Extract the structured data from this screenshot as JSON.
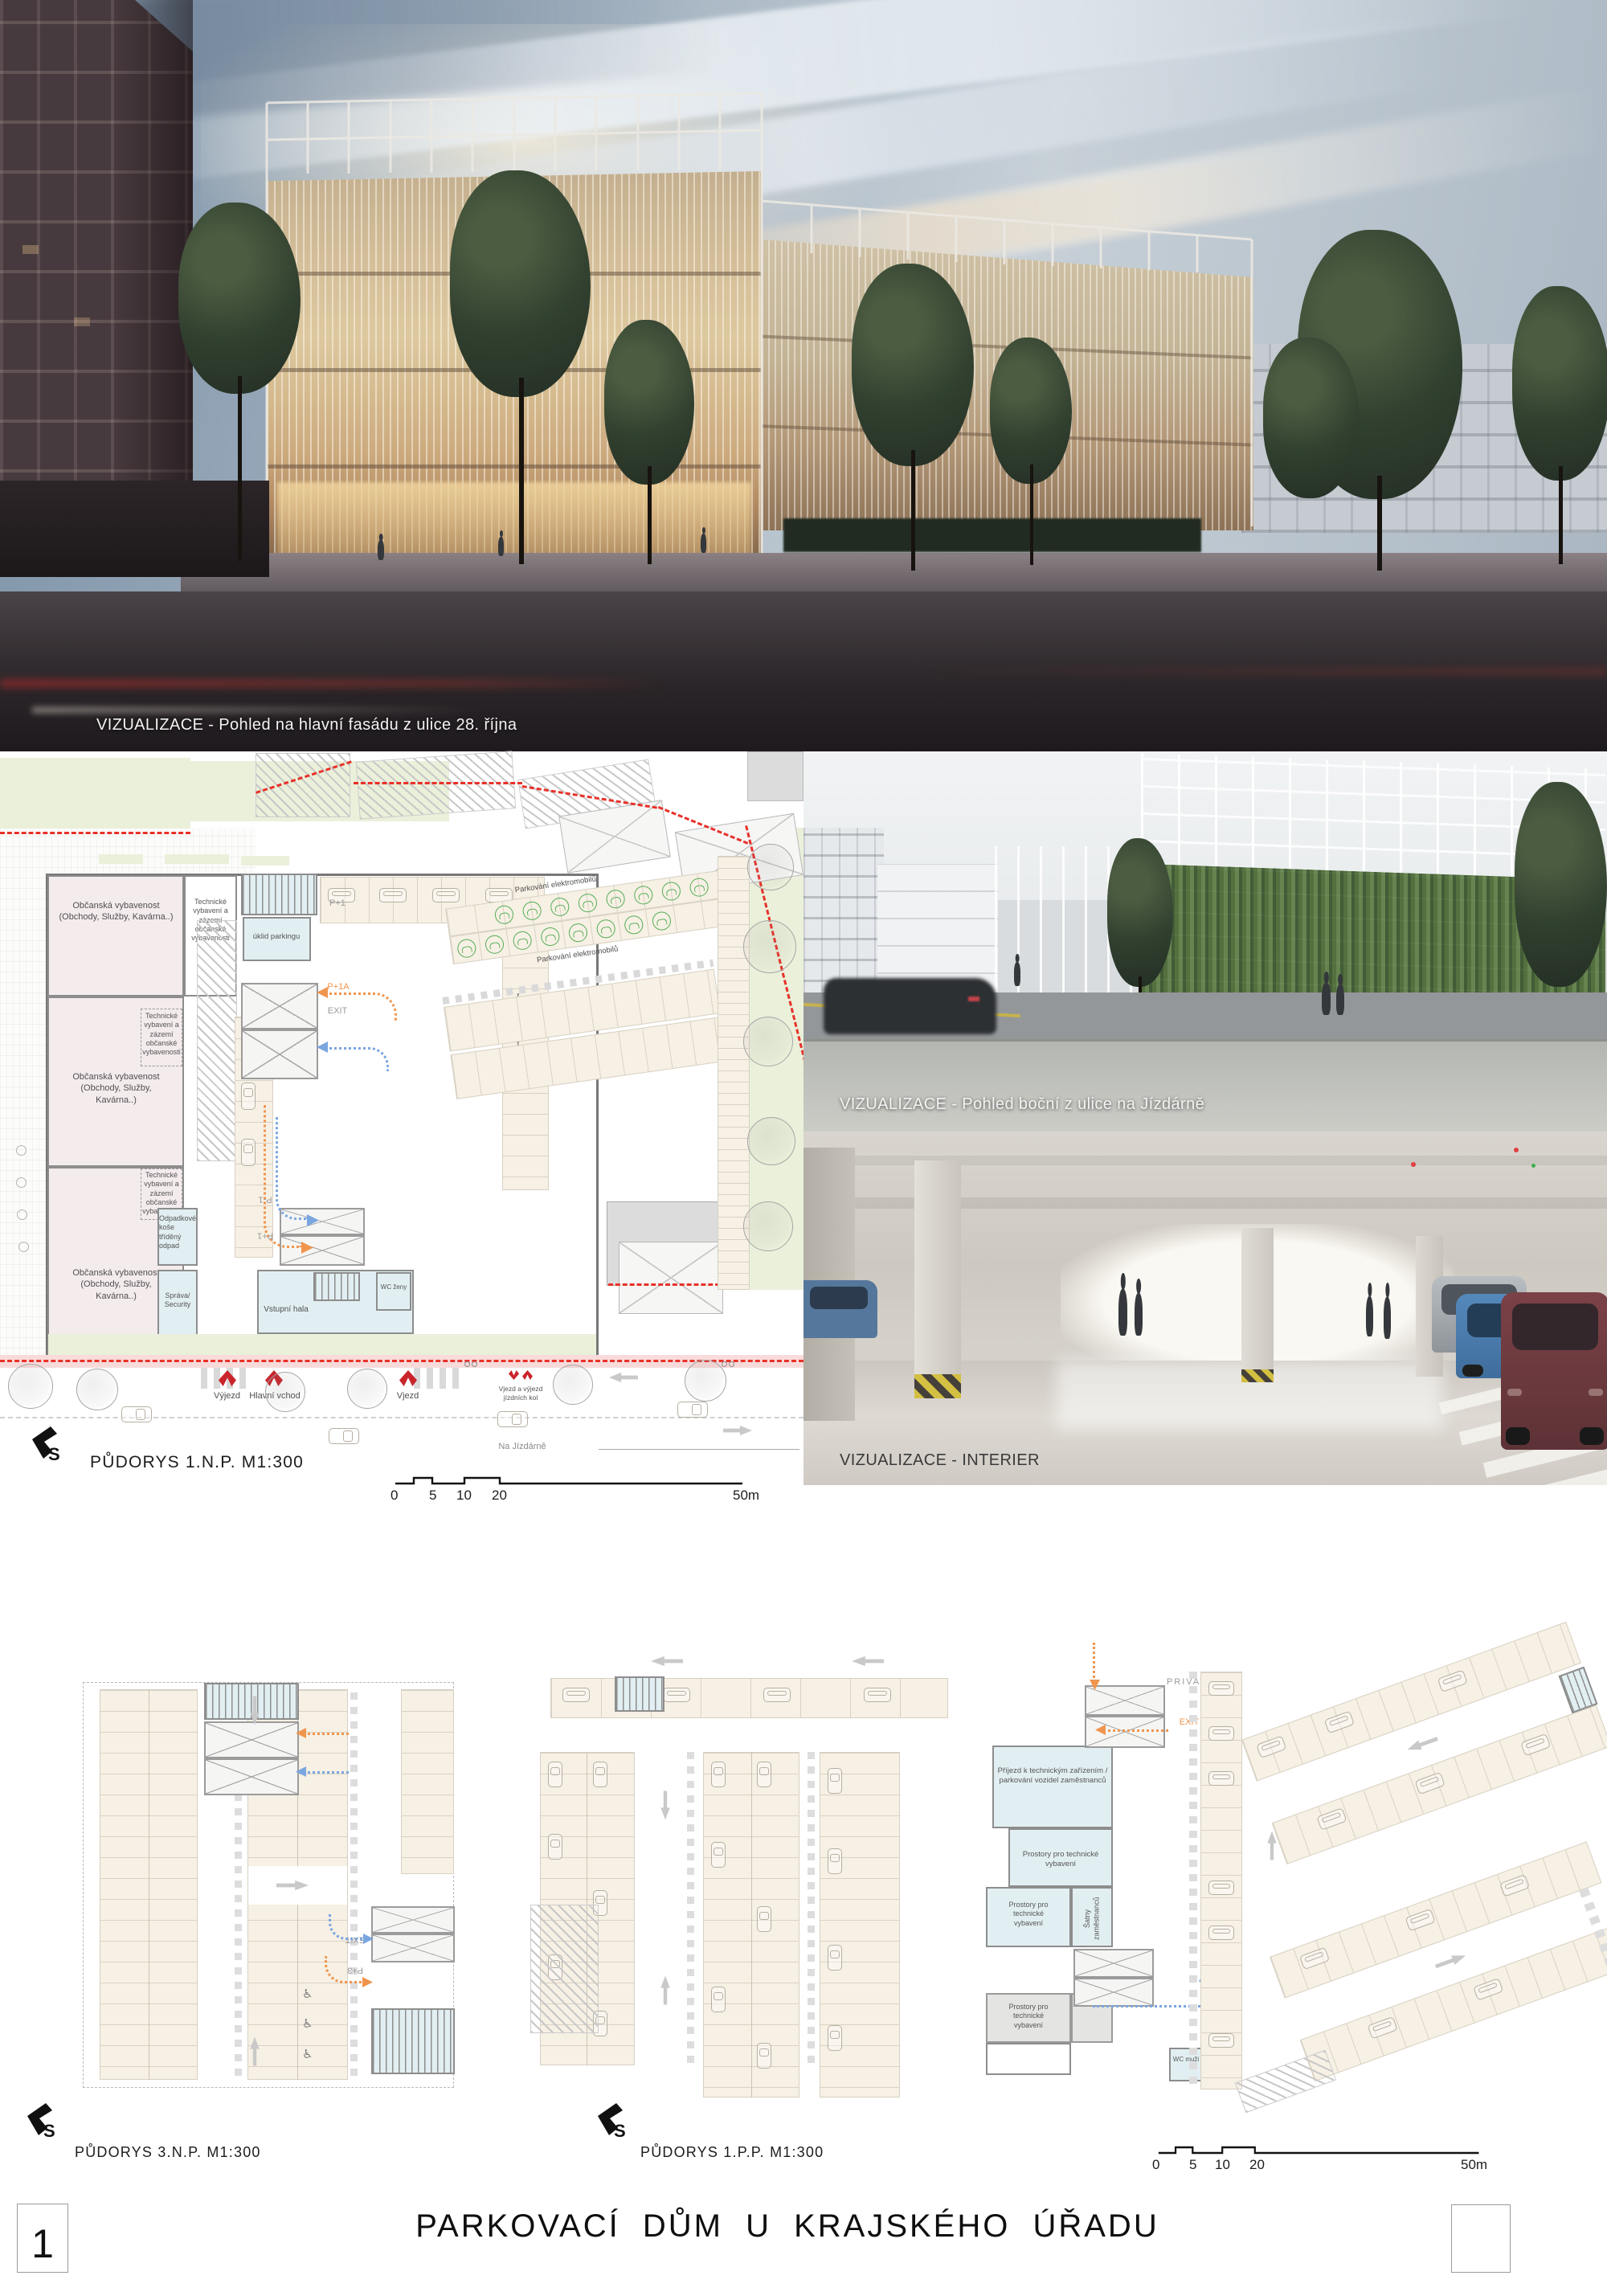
{
  "board": {
    "title": "PARKOVACÍ  DŮM  U  KRAJSKÉHO  ÚŘADU",
    "sheet_number": "1"
  },
  "visualizations": {
    "main": {
      "caption": "VIZUALIZACE - Pohled na hlavní fasádu z ulice 28. října"
    },
    "side": {
      "caption": "VIZUALIZACE - Pohled boční z ulice na Jízdárně"
    },
    "interior": {
      "caption": "VIZUALIZACE - INTERIER"
    }
  },
  "north": {
    "letter": "S"
  },
  "scalebar": {
    "t0": "0",
    "t5": "5",
    "t10": "10",
    "t20": "20",
    "t50": "50m"
  },
  "plan_1np": {
    "title": "PŮDORYS 1.N.P.  M1:300",
    "street": "Na Jízdárně",
    "rooms": {
      "retail": "Občanská vybavenost (Obchody, Služby, Kavárna..)",
      "technical": "Technické vybavení a zázemí občanské vybavenosti",
      "cleaning": "úklid parkingu",
      "waste": "Odpadkové koše tříděný odpad",
      "security": "Správa/ Security",
      "entrance_hall": "Vstupní hala",
      "wc_women": "WC ženy",
      "ev_parking": "Parkování elektromobilů"
    },
    "ramps": {
      "p1": "P+1",
      "p1a": "P+1A",
      "pm1": "P-1",
      "exit": "EXIT"
    },
    "entries": {
      "car_exit": "Výjezd",
      "main_entrance": "Hlavní vchod",
      "car_entry": "Vjezd",
      "bikes": "Vjezd a výjezd jízdních kol"
    }
  },
  "plan_3np": {
    "title": "PŮDORYS 3.N.P.  M1:300",
    "ramps": {
      "exit": "EXIT",
      "p3": "P+3"
    }
  },
  "plan_1pp": {
    "title": "PŮDORYS 1.P.P.  M1:300",
    "rooms": {
      "tech_access": "Příjezd k technickým zařízením / parkování vozidel zaměstnanců",
      "tech": "Prostory pro technické vybavení",
      "lockers": "Šatny zaměstnanců",
      "wc_men": "WC muži"
    },
    "ramps": {
      "privat": "PRIVAT",
      "exit": "EXIT"
    }
  },
  "icons": {
    "accessible": "♿"
  },
  "colors": {
    "boundary_red": "#e8312a",
    "route_orange": "#f0954e",
    "route_blue": "#7aa6e0",
    "lawn": "#eaf0da",
    "stall": "#f7f0e4",
    "room_pink": "#f4ebed",
    "room_blue": "#e2eff2",
    "ev_green": "#54ae58",
    "entry_red": "#c9252b"
  }
}
